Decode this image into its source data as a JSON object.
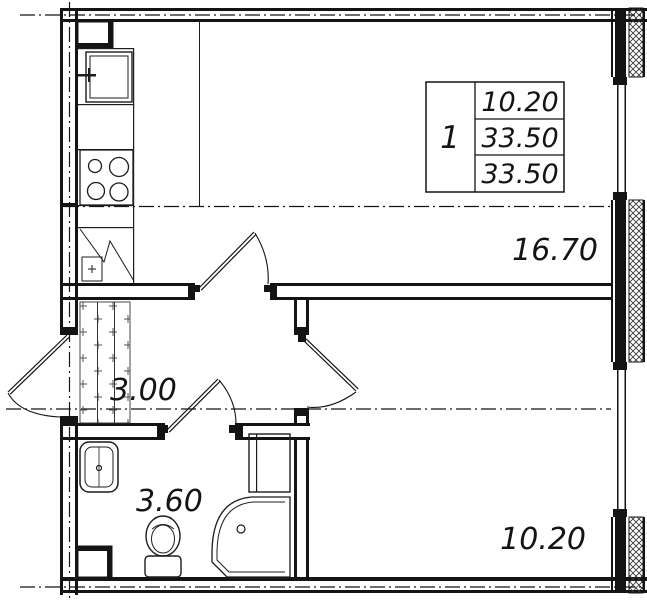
{
  "plan": {
    "type": "apartment-floor-plan",
    "rooms": {
      "living": {
        "label": "16.70"
      },
      "hall": {
        "label": "3.00"
      },
      "bath": {
        "label": "3.60"
      },
      "bedroom": {
        "label": "10.20"
      }
    },
    "info_table": {
      "flat_number": "1",
      "rows": [
        "10.20",
        "33.50",
        "33.50"
      ]
    },
    "colors": {
      "ink": "#141414",
      "bg": "#ffffff"
    }
  }
}
